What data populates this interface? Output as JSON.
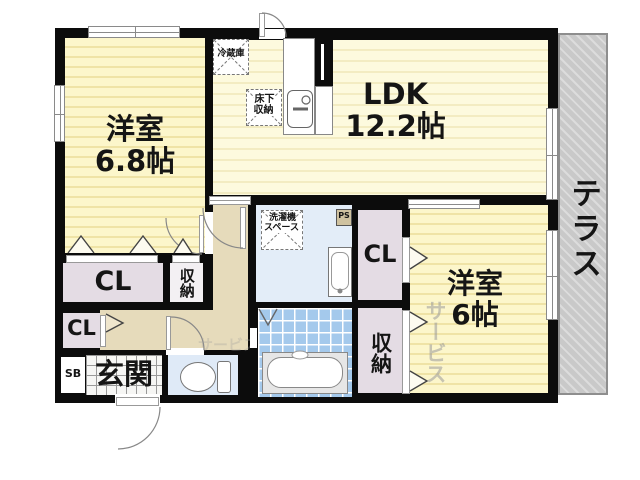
{
  "rooms": {
    "bedroom1": {
      "label": "洋室\n6.8帖"
    },
    "ldk": {
      "label": "LDK\n12.2帖"
    },
    "bedroom2": {
      "label": "洋室\n6帖"
    },
    "terrace": {
      "label": "テラス"
    },
    "entrance": {
      "label": "玄関"
    }
  },
  "storage": {
    "closet_bedroom1": "CL",
    "closet_hall": "CL",
    "closet_bedroom2": "CL",
    "oshiire_bedroom1": "収納",
    "oshiire_bedroom2": "収納",
    "shoe_box": "SB"
  },
  "fixtures": {
    "refrigerator": "冷蔵庫",
    "underfloor_storage": "床下\n収納",
    "washer_space": "洗濯機\nスペース",
    "pipe_space": "PS"
  },
  "watermark": {
    "text": "サービス"
  },
  "colors": {
    "wall": "#0c0c0c",
    "room_yellow": "#fcf6cb",
    "room_stripe": "#efe3a6",
    "closet_lavender": "#e4dce4",
    "hallway_tan": "#e6dbbb",
    "washroom_blue": "#e3edf8",
    "bath_tile_blue": "#a4c9ec",
    "toilet_blue": "#dfeaf7",
    "terrace_gray": "#c9c9c9"
  }
}
